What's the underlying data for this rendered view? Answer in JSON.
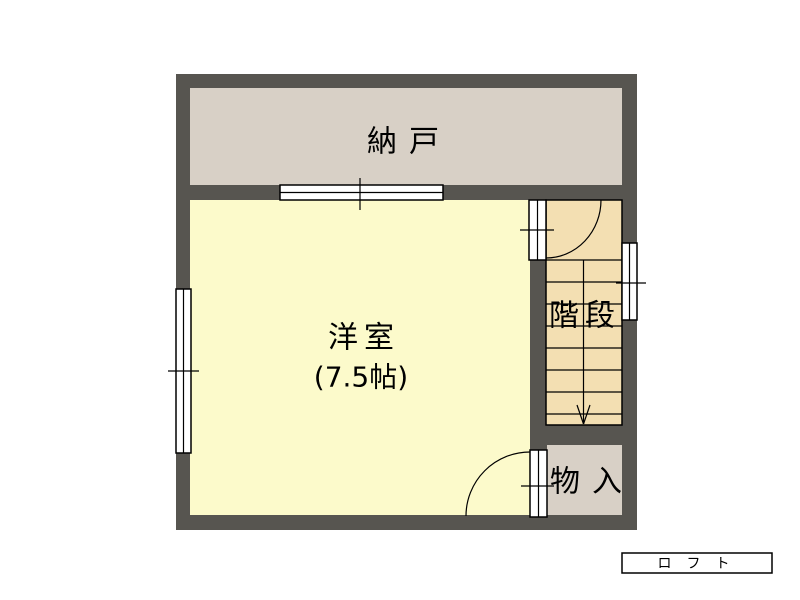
{
  "background": "#ffffff",
  "colors": {
    "wall": "#575550",
    "line": "#000000",
    "nando_fill": "#d8d0c6",
    "yoshitsu_fill": "#fcfacb",
    "kaidan_fill": "#f3dfb2",
    "monoire_fill": "#d8d0c6",
    "opening_fill": "#ffffff",
    "loft_box_fill": "#ffffff"
  },
  "rooms": {
    "nando": {
      "label": "納戸"
    },
    "yoshitsu": {
      "label": "洋室",
      "size": "(7.5帖)"
    },
    "kaidan": {
      "label": "階段"
    },
    "monoire": {
      "label": "物入"
    }
  },
  "loft": {
    "label": "ロフト"
  }
}
